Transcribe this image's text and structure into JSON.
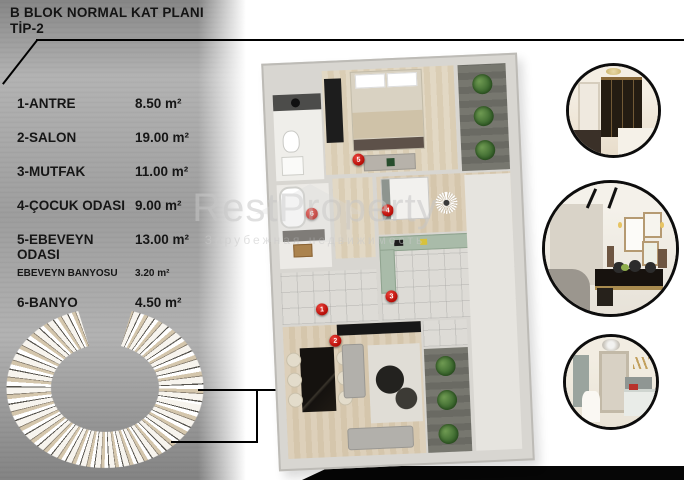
{
  "header": {
    "title_line1": "B BLOK NORMAL KAT PLANI",
    "title_line2": "TİP-2"
  },
  "room_list": [
    {
      "label": "1-ANTRE",
      "area": "8.50 m²"
    },
    {
      "label": "2-SALON",
      "area": "19.00 m²"
    },
    {
      "label": "3-MUTFAK",
      "area": "11.00 m²"
    },
    {
      "label": "4-ÇOCUK ODASI",
      "area": "9.00 m²"
    },
    {
      "label": "5-EBEVEYN ODASI",
      "area": "13.00 m²"
    },
    {
      "label": "EBEVEYN BANYOSU",
      "area": "3.20 m²"
    },
    {
      "label": "6-BANYO",
      "area": "4.50 m²"
    }
  ],
  "watermark": {
    "brand": "RestProperty",
    "subtitle": "Зарубежная недвижимость"
  },
  "floorplan": {
    "markers": [
      {
        "n": "5"
      },
      {
        "n": "6"
      },
      {
        "n": "4"
      },
      {
        "n": "3"
      },
      {
        "n": "1"
      },
      {
        "n": "2"
      }
    ]
  },
  "colors": {
    "accent_red": "#c40f0f",
    "panel_gray": "#a6a6a6",
    "line_black": "#000000"
  }
}
